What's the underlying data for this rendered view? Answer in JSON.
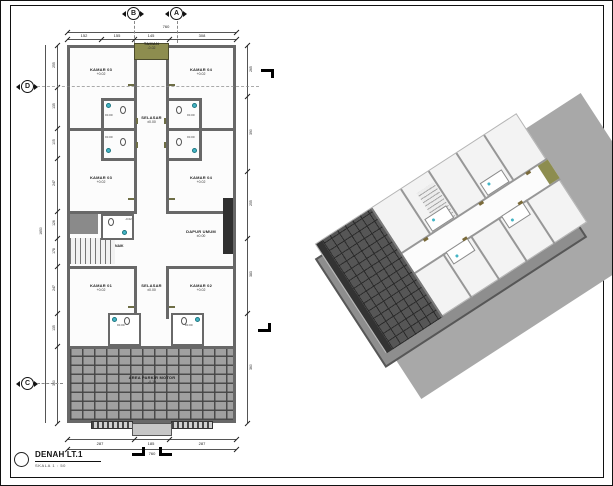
{
  "title_block": {
    "title": "DENAH LT.1",
    "scale": "SKALA 1 : 50"
  },
  "grid_markers": {
    "a": "A",
    "b": "B",
    "c": "C",
    "d": "D"
  },
  "rooms": [
    {
      "name": "KAMAR 03",
      "level": "+0.02"
    },
    {
      "name": "KAMAR 04",
      "level": "+0.02"
    },
    {
      "name": "KAMAR 03",
      "level": "+0.02"
    },
    {
      "name": "KAMAR 04",
      "level": "+0.02"
    },
    {
      "name": "KAMAR 01",
      "level": "+0.02"
    },
    {
      "name": "KAMAR 02",
      "level": "+0.02"
    }
  ],
  "areas": {
    "taman": {
      "name": "TAMAN",
      "level": "-0.02"
    },
    "selasar_upper": {
      "name": "SELASAR",
      "level": "±0.00"
    },
    "selasar_lower": {
      "name": "SELASAR",
      "level": "±0.00"
    },
    "dapur": {
      "name": "DAPUR UMUM",
      "level": "±0.00"
    },
    "parkir": {
      "name": "AREA PARKIR MOTOR",
      "level": "-0.10"
    },
    "stair": {
      "label": "NAIK"
    }
  },
  "bath_levels": {
    "standard": "±0.00",
    "small": "-0.02"
  },
  "dimensions": {
    "top_total": "760",
    "top_segments": [
      "152",
      "155",
      "145",
      "308"
    ],
    "bottom_segments": [
      "287",
      "185",
      "287"
    ],
    "bottom_total": "760",
    "left_segments": [
      "255",
      "135",
      "105",
      "247",
      "126",
      "178",
      "247",
      "135",
      "360"
    ],
    "left_total": "1650",
    "right_segments": [
      "265",
      "390",
      "255",
      "383",
      "360"
    ]
  },
  "colors": {
    "wall": "#686868",
    "taman_olive": "#8d8d4f",
    "fixture_teal": "#45b5c6",
    "parking_tile": "#a0a0a0",
    "counter_dark": "#303030",
    "shadow": "#a8a8a8"
  }
}
